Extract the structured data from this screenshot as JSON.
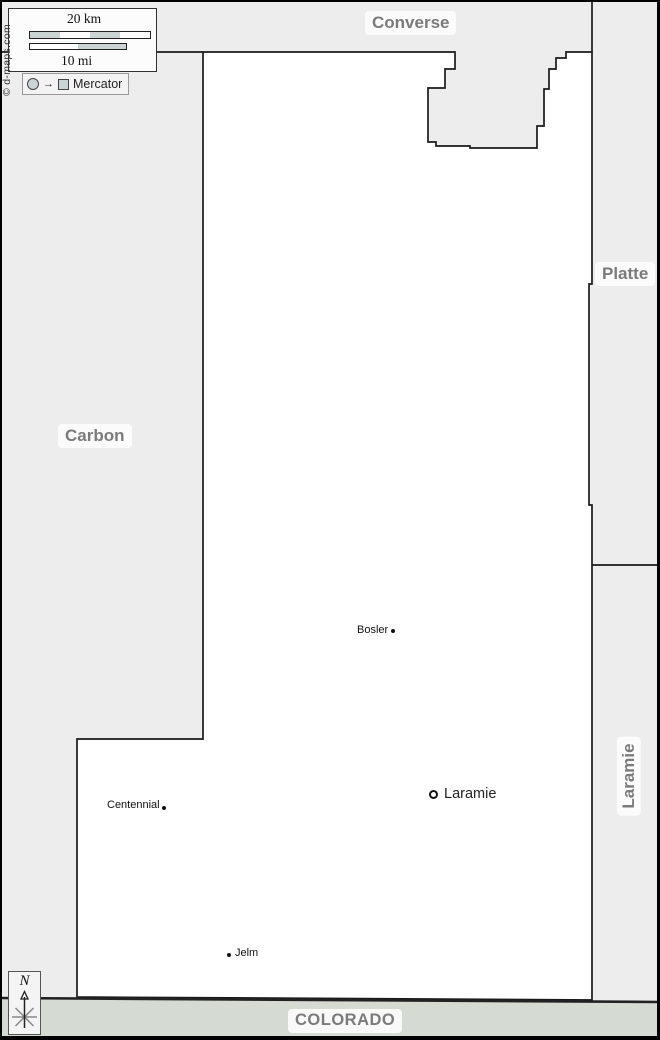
{
  "map": {
    "neighbors": {
      "converse": "Converse",
      "platte": "Platte",
      "carbon": "Carbon",
      "laramie_county": "Laramie",
      "colorado": "COLORADO"
    },
    "cities": [
      {
        "name": "Bosler",
        "marker": "dot"
      },
      {
        "name": "Laramie",
        "marker": "ring",
        "type": "major"
      },
      {
        "name": "Centennial",
        "marker": "dot"
      },
      {
        "name": "Jelm",
        "marker": "dot"
      }
    ]
  },
  "scale": {
    "km_label": "20 km",
    "mi_label": "10 mi"
  },
  "projection": {
    "label": "Mercator"
  },
  "copyright": "© d-maps.com",
  "compass": {
    "north_label": "N"
  },
  "colors": {
    "map_background": "#ededed",
    "county_fill": "#ffffff",
    "colorado_band": "#d5dad2",
    "border_line": "#1a1a1a",
    "label_text": "#7b7b7b",
    "scale_segment": "#ccd4d3"
  }
}
